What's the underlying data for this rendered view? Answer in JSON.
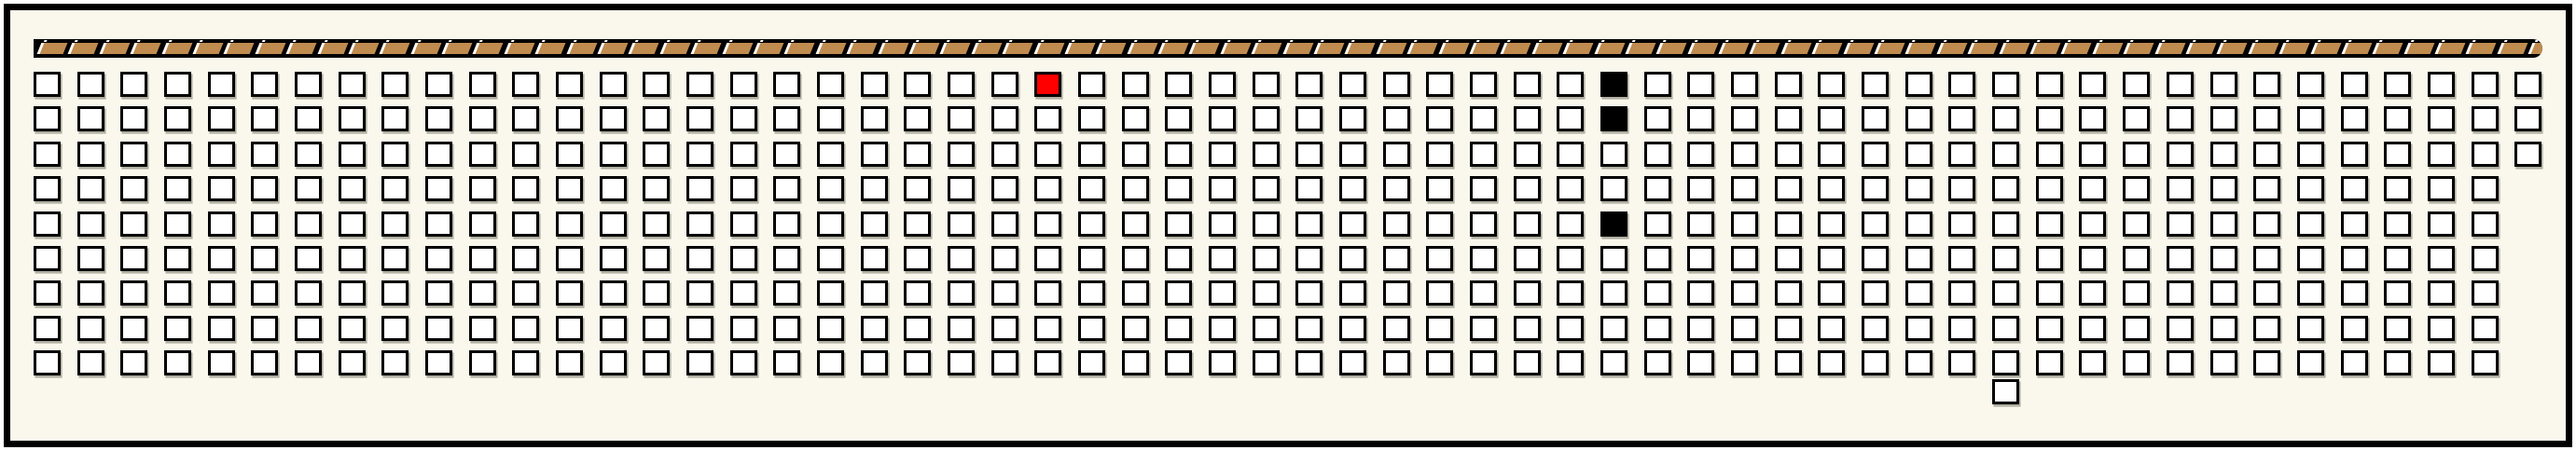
{
  "panel": {
    "description": "long horizontal seating/slot map panel with hatched strip on top and grid of selectable squares"
  },
  "colors": {
    "background": "#FAF8EC",
    "border": "#000000",
    "cell_fill": "#FFFFFF",
    "cell_border": "#000000",
    "highlight_red": "#FF0000",
    "filled_black": "#000000",
    "strip_bar": "#000000",
    "strip_segment": "#C08B4F",
    "strip_separator": "#FFFFFF"
  },
  "strip": {
    "segment_count": 81
  },
  "grid": {
    "columns": 58,
    "rows": 9,
    "red_cells": [
      {
        "row": 0,
        "col": 23
      }
    ],
    "black_cells": [
      {
        "row": 0,
        "col": 36
      },
      {
        "row": 1,
        "col": 36
      },
      {
        "row": 4,
        "col": 36
      }
    ],
    "missing_cells": [
      {
        "row": 3,
        "col": 57
      },
      {
        "row": 4,
        "col": 57
      },
      {
        "row": 5,
        "col": 57
      },
      {
        "row": 6,
        "col": 57
      },
      {
        "row": 7,
        "col": 57
      },
      {
        "row": 8,
        "col": 57
      }
    ],
    "extra_cells": [
      {
        "below_row": 8,
        "col": 45
      }
    ]
  }
}
